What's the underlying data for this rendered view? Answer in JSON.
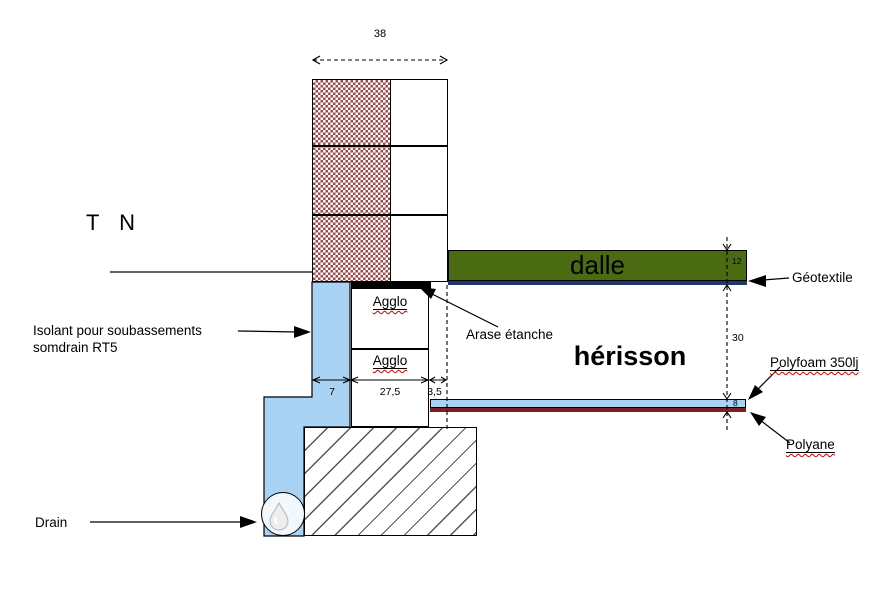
{
  "colors": {
    "hatch_red": "#9e4a4a",
    "insulation_blue": "#a9d3f5",
    "slab_green": "#4a6b12",
    "geotextile_navy": "#1f3a68",
    "polyane_red": "#7a2020",
    "squiggle_red": "#d00000"
  },
  "annotations": {
    "tn": "T N",
    "isolant_line1": "Isolant pour soubassements",
    "isolant_line2": "somdrain RT5",
    "drain": "Drain",
    "arase": "Arase étanche",
    "geotextile": "Géotextile",
    "polyfoam": "Polyfoam 350lj",
    "polyane": "Polyane"
  },
  "layers": {
    "dalle": "dalle",
    "herisson": "hérisson",
    "agglo_top": "Agglo",
    "agglo_bottom": "Agglo"
  },
  "dimensions": {
    "wall_width": "38",
    "insulation_width": "7",
    "agglo_width": "27,5",
    "gap_width": "3,5",
    "dalle_thickness": "12",
    "herisson_height": "30",
    "polyfoam_thickness": "8"
  }
}
